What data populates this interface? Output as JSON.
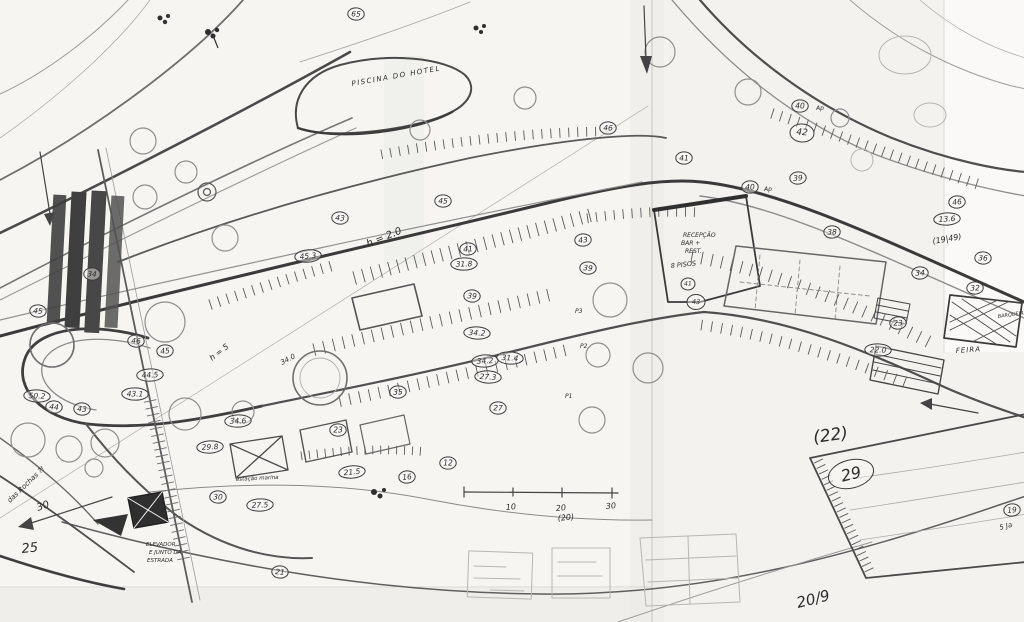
{
  "document": {
    "description": "hand-drawn site plan sketch (pencil on taped sheets)"
  },
  "palette": {
    "paper": "#f6f5f2",
    "paper_shade": "#efeeea",
    "ink_dark": "#3a3a3a",
    "ink_mid": "#5a5a5a",
    "ink_light": "#9a9a9a"
  },
  "scale_bar": {
    "tick_labels": [
      "10",
      "20",
      "30"
    ],
    "bracket_note": "(20)"
  },
  "labels": [
    {
      "id": "piscina",
      "text": "PISCINA DO HOTEL",
      "x": 352,
      "y": 86,
      "size": 7,
      "rot": -10,
      "ls": 1.5
    },
    {
      "id": "h20",
      "text": "h = 2.0",
      "x": 368,
      "y": 247,
      "size": 10,
      "rot": -22
    },
    {
      "id": "h5",
      "text": "h = 5",
      "x": 212,
      "y": 361,
      "size": 8,
      "rot": -38
    },
    {
      "id": "recepcao",
      "text": "RECEPÇÃO",
      "x": 683,
      "y": 237,
      "size": 6
    },
    {
      "id": "bar",
      "text": "BAR +",
      "x": 681,
      "y": 245,
      "size": 6
    },
    {
      "id": "rest",
      "text": "REST.",
      "x": 685,
      "y": 253,
      "size": 6
    },
    {
      "id": "pisos",
      "text": "8 PISOS",
      "x": 671,
      "y": 268,
      "size": 6.5,
      "rot": -6
    },
    {
      "id": "elevador1",
      "text": "ELEVADOR",
      "x": 146,
      "y": 546,
      "size": 5.5
    },
    {
      "id": "elevador2",
      "text": "E JUNTO DA",
      "x": 149,
      "y": 554,
      "size": 5.5
    },
    {
      "id": "elevador3",
      "text": "ESTRADA",
      "x": 147,
      "y": 562,
      "size": 5.5
    },
    {
      "id": "feira",
      "text": "FEIRA",
      "x": 956,
      "y": 353,
      "size": 7,
      "rot": -4,
      "ls": 1
    },
    {
      "id": "barqueira",
      "text": "BARQUEIRA",
      "x": 998,
      "y": 318,
      "size": 5,
      "rot": -8
    },
    {
      "id": "marina",
      "text": "estação marina",
      "x": 236,
      "y": 481,
      "size": 5.5,
      "rot": -3
    },
    {
      "id": "n22",
      "text": "(22)",
      "x": 814,
      "y": 443,
      "size": 17,
      "rot": -8
    },
    {
      "id": "date",
      "text": "20/9",
      "x": 798,
      "y": 608,
      "size": 15,
      "rot": -14
    },
    {
      "id": "n25",
      "text": "25",
      "x": 22,
      "y": 553,
      "size": 13,
      "rot": -6
    },
    {
      "id": "n30arrow",
      "text": "30",
      "x": 38,
      "y": 511,
      "size": 10,
      "rot": -20
    },
    {
      "id": "rochas",
      "text": "das Rochas ?!",
      "x": 10,
      "y": 503,
      "size": 7,
      "rot": -44
    },
    {
      "id": "n1949",
      "text": "(19|49)",
      "x": 933,
      "y": 244,
      "size": 8,
      "rot": -10
    },
    {
      "id": "n340",
      "text": "34.0",
      "x": 282,
      "y": 365,
      "size": 7,
      "rot": -28
    },
    {
      "id": "p3",
      "text": "P3",
      "x": 575,
      "y": 313,
      "size": 6
    },
    {
      "id": "p2",
      "text": "P2",
      "x": 580,
      "y": 348,
      "size": 6
    },
    {
      "id": "p1",
      "text": "P1",
      "x": 565,
      "y": 398,
      "size": 6
    },
    {
      "id": "ap1",
      "text": "Ap",
      "x": 764,
      "y": 191,
      "size": 6
    },
    {
      "id": "ap2",
      "text": "Ap",
      "x": 816,
      "y": 110,
      "size": 6
    },
    {
      "id": "t10",
      "text": "10",
      "x": 506,
      "y": 510,
      "size": 8,
      "rot": -5
    },
    {
      "id": "t20",
      "text": "20",
      "x": 556,
      "y": 511,
      "size": 8,
      "rot": -5
    },
    {
      "id": "t30",
      "text": "30",
      "x": 606,
      "y": 509,
      "size": 8,
      "rot": -5
    },
    {
      "id": "n20p",
      "text": "(20)",
      "x": 558,
      "y": 521,
      "size": 8,
      "rot": -6
    },
    {
      "id": "ja",
      "text": "5 Ja",
      "x": 1000,
      "y": 530,
      "size": 7,
      "rot": -15
    }
  ],
  "markers": [
    {
      "v": "65",
      "x": 356,
      "y": 14
    },
    {
      "v": "46",
      "x": 608,
      "y": 128
    },
    {
      "v": "41",
      "x": 684,
      "y": 158
    },
    {
      "v": "40",
      "x": 750,
      "y": 187
    },
    {
      "v": "39",
      "x": 798,
      "y": 178
    },
    {
      "v": "38",
      "x": 832,
      "y": 232
    },
    {
      "v": "42",
      "x": 802,
      "y": 133,
      "size": 9,
      "rx": 12,
      "ry": 9
    },
    {
      "v": "40",
      "x": 800,
      "y": 106
    },
    {
      "v": "46",
      "x": 957,
      "y": 202
    },
    {
      "v": "13.6",
      "x": 947,
      "y": 219
    },
    {
      "v": "36",
      "x": 983,
      "y": 258
    },
    {
      "v": "34",
      "x": 920,
      "y": 273
    },
    {
      "v": "32",
      "x": 975,
      "y": 288
    },
    {
      "v": "23",
      "x": 898,
      "y": 323
    },
    {
      "v": "22.0",
      "x": 878,
      "y": 350
    },
    {
      "v": "45",
      "x": 443,
      "y": 201
    },
    {
      "v": "43",
      "x": 340,
      "y": 218
    },
    {
      "v": "45.3",
      "x": 308,
      "y": 256
    },
    {
      "v": "41",
      "x": 468,
      "y": 249
    },
    {
      "v": "31.8",
      "x": 464,
      "y": 264
    },
    {
      "v": "43",
      "x": 583,
      "y": 240
    },
    {
      "v": "39",
      "x": 588,
      "y": 268
    },
    {
      "v": "39",
      "x": 472,
      "y": 296
    },
    {
      "v": "34.2",
      "x": 477,
      "y": 333
    },
    {
      "v": "34.2",
      "x": 485,
      "y": 361
    },
    {
      "v": "31.4",
      "x": 510,
      "y": 358
    },
    {
      "v": "27.3",
      "x": 488,
      "y": 377
    },
    {
      "v": "27",
      "x": 498,
      "y": 408
    },
    {
      "v": "35",
      "x": 398,
      "y": 392
    },
    {
      "v": "34.6",
      "x": 238,
      "y": 421
    },
    {
      "v": "29.8",
      "x": 210,
      "y": 447
    },
    {
      "v": "30",
      "x": 218,
      "y": 497
    },
    {
      "v": "27.5",
      "x": 260,
      "y": 505
    },
    {
      "v": "23",
      "x": 338,
      "y": 430
    },
    {
      "v": "21.5",
      "x": 352,
      "y": 472
    },
    {
      "v": "21",
      "x": 280,
      "y": 572
    },
    {
      "v": "44",
      "x": 54,
      "y": 407
    },
    {
      "v": "43",
      "x": 82,
      "y": 409
    },
    {
      "v": "43.1",
      "x": 135,
      "y": 394
    },
    {
      "v": "45",
      "x": 38,
      "y": 311
    },
    {
      "v": "50.2",
      "x": 37,
      "y": 396
    },
    {
      "v": "46",
      "x": 136,
      "y": 341
    },
    {
      "v": "45",
      "x": 165,
      "y": 351
    },
    {
      "v": "44.5",
      "x": 150,
      "y": 375
    },
    {
      "v": "34",
      "x": 92,
      "y": 274
    },
    {
      "v": "12",
      "x": 448,
      "y": 463
    },
    {
      "v": "16",
      "x": 407,
      "y": 477
    },
    {
      "v": "19",
      "x": 1012,
      "y": 510
    },
    {
      "v": "41",
      "x": 688,
      "y": 284,
      "size": 6,
      "rx": 7,
      "ry": 6
    },
    {
      "v": "43",
      "x": 696,
      "y": 302,
      "size": 6.5,
      "rx": 9,
      "ry": 7.5
    },
    {
      "v": "29",
      "x": 851,
      "y": 474,
      "size": 16,
      "rx": 23,
      "ry": 14,
      "rot": -14
    }
  ]
}
